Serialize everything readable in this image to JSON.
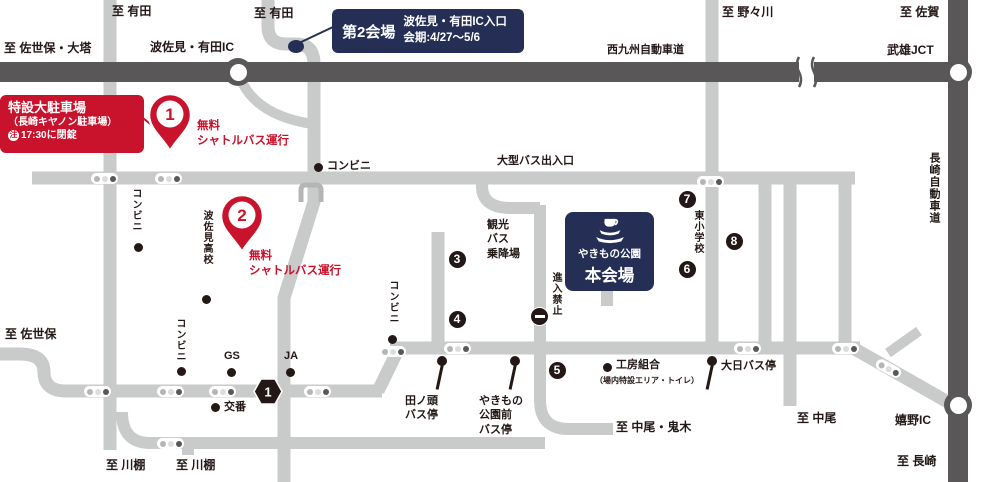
{
  "colors": {
    "road_light": "#c9caca",
    "road_dark": "#595757",
    "text_dark": "#231815",
    "accent_red": "#c9122b",
    "accent_navy": "#252f56"
  },
  "venue2": {
    "title": "第2会場",
    "line1": "波佐見・有田IC入口",
    "line2": "会期:4/27～5/6"
  },
  "main_venue": {
    "park": "やきもの公園",
    "hall": "本会場"
  },
  "parking": {
    "line1": "特設大駐車場",
    "line2": "（長崎キヤノン駐車場）",
    "note_mark": "注",
    "note_text": "17:30に閉錠"
  },
  "labels": [
    {
      "id": "to-arita-left",
      "t": "至 有田",
      "x": 112,
      "y": 5
    },
    {
      "id": "to-arita-mid",
      "t": "至 有田",
      "x": 254,
      "y": 7
    },
    {
      "id": "to-sasebo-daito",
      "t": "至 佐世保・大塔",
      "x": 4,
      "y": 42
    },
    {
      "id": "hasami-arita-ic-label",
      "t": "波佐見・有田IC",
      "x": 150,
      "y": 41
    },
    {
      "id": "nishi-kyushu-expwy-label",
      "t": "西九州自動車道",
      "x": 607,
      "y": 45,
      "s": 11
    },
    {
      "id": "to-nonogawa",
      "t": "至 野々川",
      "x": 722,
      "y": 6
    },
    {
      "id": "to-saga",
      "t": "至 佐賀",
      "x": 900,
      "y": 6
    },
    {
      "id": "takeo-jct-label",
      "t": "武雄JCT",
      "x": 887,
      "y": 44
    },
    {
      "id": "nagasaki-expwy-label",
      "t": "長崎自動車道",
      "x": 928,
      "y": 152,
      "v": 1,
      "s": 11
    },
    {
      "id": "conbini-arita-road",
      "t": "コンビニ",
      "x": 130,
      "y": 188,
      "v": 1,
      "s": 10
    },
    {
      "id": "hasami-highschool-label",
      "t": "波佐見高校",
      "x": 201,
      "y": 210,
      "v": 1,
      "s": 10
    },
    {
      "id": "conbini-top-label",
      "t": "コンビニ",
      "x": 327,
      "y": 161,
      "s": 11
    },
    {
      "id": "large-bus-gate-label",
      "t": "大型バス出入口",
      "x": 497,
      "y": 156,
      "s": 11
    },
    {
      "id": "higashi-elementary-label",
      "t": "東小学校",
      "x": 692,
      "y": 210,
      "v": 1,
      "s": 10
    },
    {
      "id": "no-entry-label",
      "t": "進入禁止",
      "x": 550,
      "y": 272,
      "v": 1,
      "s": 10
    },
    {
      "id": "conbini-mid-label",
      "t": "コンビニ",
      "x": 387,
      "y": 280,
      "v": 1,
      "s": 10
    },
    {
      "id": "conbini-left-label",
      "t": "コンビニ",
      "x": 174,
      "y": 318,
      "v": 1,
      "s": 10
    },
    {
      "id": "to-sasebo",
      "t": "至 佐世保",
      "x": 5,
      "y": 328
    },
    {
      "id": "gs-label",
      "t": "GS",
      "x": 224,
      "y": 351,
      "s": 11
    },
    {
      "id": "ja-label",
      "t": "JA",
      "x": 284,
      "y": 351,
      "s": 11
    },
    {
      "id": "koban-label",
      "t": "交番",
      "x": 224,
      "y": 402,
      "s": 11
    },
    {
      "id": "kobo-kumiai-label",
      "t": "工房組合",
      "x": 616,
      "y": 360,
      "s": 11
    },
    {
      "id": "kobo-kumiai-note",
      "t": "（場内特設エリア・トイレ）",
      "x": 595,
      "y": 377,
      "s": 8
    },
    {
      "id": "dainichi-bus-stop-label",
      "t": "大日バス停",
      "x": 721,
      "y": 361,
      "s": 11
    },
    {
      "id": "to-nakao-oniki",
      "t": "至 中尾・鬼木",
      "x": 616,
      "y": 421
    },
    {
      "id": "to-nakao",
      "t": "至 中尾",
      "x": 797,
      "y": 412
    },
    {
      "id": "ureshino-ic-label",
      "t": "嬉野IC",
      "x": 895,
      "y": 414
    },
    {
      "id": "to-nagasaki",
      "t": "至 長崎",
      "x": 897,
      "y": 455
    },
    {
      "id": "to-kawatana-1",
      "t": "至 川棚",
      "x": 106,
      "y": 459
    },
    {
      "id": "to-kawatana-2",
      "t": "至 川棚",
      "x": 176,
      "y": 459
    }
  ],
  "text_blocks": [
    {
      "id": "shuttle-note-1",
      "x": 197,
      "y": 119,
      "cls": "red",
      "lines": [
        "無料",
        "シャトルバス運行"
      ]
    },
    {
      "id": "shuttle-note-2",
      "x": 249,
      "y": 249,
      "cls": "red",
      "lines": [
        "無料",
        "シャトルバス運行"
      ]
    },
    {
      "id": "tour-bus-area-label",
      "x": 487,
      "y": 218,
      "cls": "",
      "lines": [
        "観光",
        "バス",
        "乗降場"
      ]
    },
    {
      "id": "tanogashira-bus-stop-label",
      "x": 405,
      "y": 394,
      "cls": "",
      "lines": [
        "田ノ頭",
        "バス停"
      ]
    },
    {
      "id": "yakimono-park-bus-stop-label",
      "x": 479,
      "y": 394,
      "cls": "",
      "lines": [
        "やきもの",
        "公園前",
        "バス停"
      ]
    }
  ],
  "signals": [
    {
      "x": 104,
      "y": 178
    },
    {
      "x": 168,
      "y": 178
    },
    {
      "x": 710,
      "y": 181
    },
    {
      "x": 392,
      "y": 351
    },
    {
      "x": 457,
      "y": 348
    },
    {
      "x": 747,
      "y": 348
    },
    {
      "x": 845,
      "y": 348
    },
    {
      "x": 888,
      "y": 368,
      "r": 28
    },
    {
      "x": 97,
      "y": 391
    },
    {
      "x": 170,
      "y": 391
    },
    {
      "x": 222,
      "y": 391
    },
    {
      "x": 317,
      "y": 391
    },
    {
      "x": 170,
      "y": 443
    }
  ],
  "poi_dots": [
    {
      "id": "conbini-arita-dot",
      "x": 138,
      "y": 247
    },
    {
      "id": "highschool-dot",
      "x": 206,
      "y": 299
    },
    {
      "id": "conbini-top-dot",
      "x": 318,
      "y": 167
    },
    {
      "id": "conbini-mid-dot",
      "x": 392,
      "y": 339
    },
    {
      "id": "conbini-left-dot",
      "x": 181,
      "y": 371
    },
    {
      "id": "gs-dot",
      "x": 231,
      "y": 372
    },
    {
      "id": "ja-dot",
      "x": 290,
      "y": 372
    },
    {
      "id": "koban-dot",
      "x": 215,
      "y": 407
    },
    {
      "id": "kobo-kumiai-dot",
      "x": 607,
      "y": 367
    }
  ],
  "numbered_markers": [
    {
      "n": "3",
      "x": 457,
      "y": 259
    },
    {
      "n": "4",
      "x": 457,
      "y": 319
    },
    {
      "n": "5",
      "x": 557,
      "y": 370
    },
    {
      "n": "6",
      "x": 687,
      "y": 269
    },
    {
      "n": "7",
      "x": 687,
      "y": 199
    },
    {
      "n": "8",
      "x": 734,
      "y": 241
    }
  ],
  "pins": [
    {
      "n": "1",
      "x": 170,
      "y": 152
    },
    {
      "n": "2",
      "x": 242,
      "y": 253
    }
  ],
  "bus_stops": [
    {
      "id": "tanogashira-bus-stop-icon",
      "x": 442,
      "y": 356
    },
    {
      "id": "yakimono-park-bus-stop-icon",
      "x": 515,
      "y": 356
    },
    {
      "id": "dainichi-bus-stop-icon",
      "x": 712,
      "y": 356
    }
  ],
  "ic_circles": [
    {
      "id": "hasami-arita-ic-circle",
      "x": 238,
      "y": 72
    },
    {
      "id": "takeo-jct-circle",
      "x": 958,
      "y": 72
    },
    {
      "id": "ureshino-ic-circle",
      "x": 958,
      "y": 405
    }
  ],
  "route_badge": {
    "number": "1",
    "x": 268,
    "y": 391
  },
  "no_entry_sign": {
    "x": 540,
    "y": 317
  },
  "venue2_dot": {
    "x": 296,
    "y": 46
  }
}
